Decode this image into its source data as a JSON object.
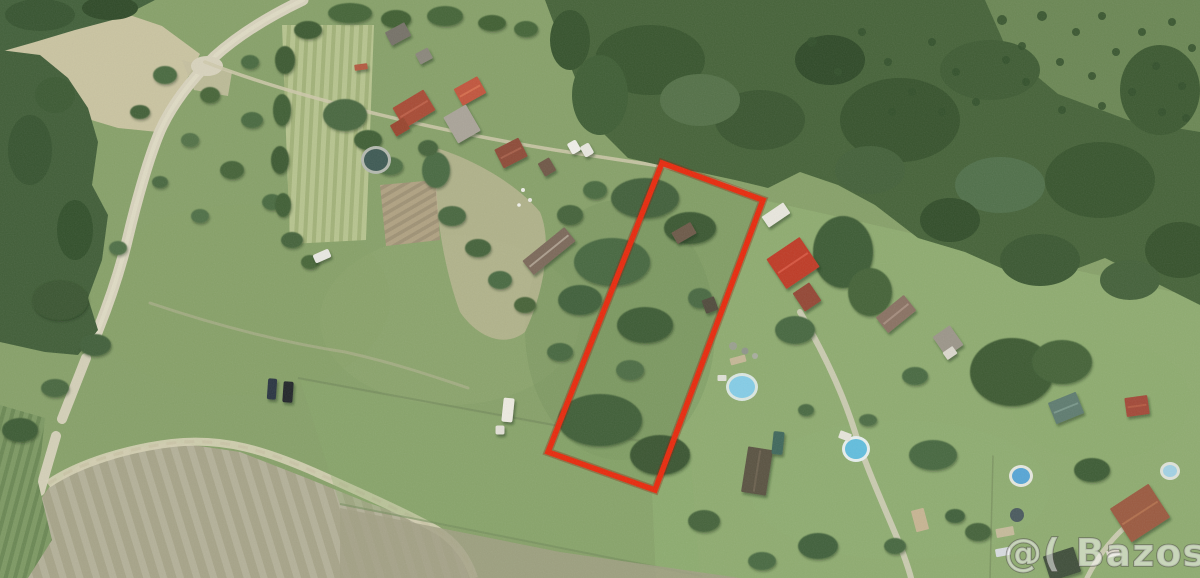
{
  "scene": {
    "label": "aerial-satellite-photo-of-rural-land-parcels",
    "base_color": "#87a169",
    "palette": {
      "grass": "#87a169",
      "lawn_bright": "#8fac70",
      "forest": "#466339",
      "dry_field": "#cac4a1",
      "road": "#d8d3bd",
      "mowed_field": "#a7a489"
    },
    "trees": [
      [
        165,
        75,
        12,
        9,
        "#4a6a40"
      ],
      [
        210,
        95,
        10,
        8,
        "#466539"
      ],
      [
        252,
        120,
        11,
        8,
        "#4a6a40"
      ],
      [
        190,
        140,
        9,
        7,
        "#527247"
      ],
      [
        232,
        170,
        12,
        9,
        "#446339"
      ],
      [
        272,
        202,
        10,
        8,
        "#4a6a40"
      ],
      [
        200,
        216,
        9,
        7,
        "#507046"
      ],
      [
        160,
        182,
        8,
        6,
        "#486740"
      ],
      [
        292,
        240,
        11,
        8,
        "#44633a"
      ],
      [
        250,
        62,
        9,
        7,
        "#4a6a40"
      ],
      [
        310,
        262,
        9,
        7,
        "#476639"
      ],
      [
        140,
        112,
        10,
        7,
        "#426138"
      ],
      [
        350,
        13,
        22,
        10,
        "#456538"
      ],
      [
        396,
        19,
        15,
        9,
        "#3f5e33"
      ],
      [
        445,
        16,
        18,
        10,
        "#456538"
      ],
      [
        492,
        23,
        14,
        8,
        "#3f5e33"
      ],
      [
        526,
        29,
        12,
        8,
        "#456538"
      ],
      [
        308,
        30,
        14,
        9,
        "#3c5a31"
      ],
      [
        285,
        60,
        10,
        14,
        "#3c5a31"
      ],
      [
        282,
        110,
        9,
        16,
        "#3f5e35"
      ],
      [
        280,
        160,
        9,
        14,
        "#3c5a31"
      ],
      [
        283,
        205,
        8,
        12,
        "#405f36"
      ],
      [
        345,
        115,
        22,
        16,
        "#486840"
      ],
      [
        368,
        140,
        14,
        10,
        "#3f5f36"
      ],
      [
        436,
        170,
        14,
        18,
        "#4a6a42"
      ],
      [
        428,
        148,
        10,
        8,
        "#44633a"
      ],
      [
        390,
        166,
        13,
        9,
        "#507045"
      ],
      [
        452,
        216,
        14,
        10,
        "#486840"
      ],
      [
        478,
        248,
        13,
        9,
        "#44633a"
      ],
      [
        500,
        280,
        12,
        9,
        "#4a6a42"
      ],
      [
        525,
        305,
        11,
        8,
        "#466439"
      ],
      [
        570,
        215,
        13,
        10,
        "#44633a"
      ],
      [
        595,
        190,
        12,
        9,
        "#4a6a40"
      ],
      [
        645,
        198,
        34,
        20,
        "#42603a"
      ],
      [
        690,
        228,
        26,
        16,
        "#3b5833"
      ],
      [
        612,
        262,
        38,
        24,
        "#476741"
      ],
      [
        580,
        300,
        22,
        15,
        "#40603a"
      ],
      [
        645,
        325,
        28,
        18,
        "#3d5c35"
      ],
      [
        700,
        298,
        12,
        10,
        "#486942"
      ],
      [
        600,
        420,
        42,
        26,
        "#415f39"
      ],
      [
        660,
        455,
        30,
        20,
        "#3a5732"
      ],
      [
        560,
        352,
        13,
        9,
        "#47673f"
      ],
      [
        630,
        370,
        14,
        10,
        "#4d6d45"
      ],
      [
        843,
        252,
        30,
        36,
        "#3d5c35"
      ],
      [
        870,
        292,
        22,
        24,
        "#446339"
      ],
      [
        795,
        330,
        20,
        14,
        "#47673f"
      ],
      [
        915,
        376,
        13,
        9,
        "#4a6a42"
      ],
      [
        1012,
        372,
        42,
        34,
        "#3c5a33"
      ],
      [
        1062,
        362,
        30,
        22,
        "#446339"
      ],
      [
        933,
        455,
        24,
        15,
        "#47673f"
      ],
      [
        818,
        546,
        20,
        13,
        "#40603a"
      ],
      [
        704,
        521,
        16,
        11,
        "#44633a"
      ],
      [
        762,
        561,
        14,
        9,
        "#4a6a42"
      ],
      [
        895,
        546,
        11,
        8,
        "#47673f"
      ],
      [
        1092,
        470,
        18,
        12,
        "#3d5c35"
      ],
      [
        978,
        532,
        13,
        9,
        "#44633a"
      ],
      [
        955,
        516,
        10,
        7,
        "#40603a"
      ],
      [
        868,
        420,
        9,
        6,
        "#4d6d45"
      ],
      [
        806,
        410,
        8,
        6,
        "#4a6a42"
      ],
      [
        60,
        300,
        28,
        20,
        "#3a5731"
      ],
      [
        95,
        345,
        16,
        11,
        "#42613a"
      ],
      [
        55,
        388,
        14,
        9,
        "#486840"
      ],
      [
        20,
        430,
        18,
        12,
        "#3d5c35"
      ],
      [
        118,
        248,
        9,
        7,
        "#507046"
      ]
    ],
    "forest_blobs": [
      [
        650,
        60,
        55,
        35,
        "#38552e"
      ],
      [
        760,
        120,
        45,
        30,
        "#3a5630"
      ],
      [
        900,
        120,
        60,
        42,
        "#37532d"
      ],
      [
        990,
        70,
        50,
        30,
        "#3f5c34"
      ],
      [
        1100,
        180,
        55,
        38,
        "#38552e"
      ],
      [
        1160,
        90,
        40,
        45,
        "#3c5931"
      ],
      [
        830,
        60,
        35,
        25,
        "#2f4a28"
      ],
      [
        700,
        100,
        40,
        26,
        "#547148"
      ],
      [
        1000,
        185,
        45,
        28,
        "#50704a"
      ],
      [
        600,
        95,
        28,
        40,
        "#3f5e35"
      ],
      [
        1180,
        250,
        35,
        28,
        "#36522c"
      ],
      [
        1040,
        260,
        40,
        26,
        "#3b5832"
      ],
      [
        950,
        220,
        30,
        22,
        "#324e2a"
      ],
      [
        870,
        170,
        35,
        24,
        "#44613a"
      ],
      [
        1130,
        280,
        30,
        20,
        "#44613a"
      ],
      [
        570,
        40,
        20,
        30,
        "#36532d"
      ],
      [
        40,
        15,
        35,
        16,
        "#375430"
      ],
      [
        110,
        8,
        28,
        12,
        "#2f4a28"
      ],
      [
        30,
        150,
        22,
        35,
        "#375430"
      ],
      [
        75,
        230,
        18,
        30,
        "#32502b"
      ],
      [
        55,
        95,
        20,
        18,
        "#3c5a33"
      ]
    ],
    "orchard_dots": [
      [
        1002,
        20,
        5
      ],
      [
        1022,
        46,
        4
      ],
      [
        1042,
        16,
        5
      ],
      [
        1060,
        62,
        4
      ],
      [
        1076,
        32,
        4
      ],
      [
        1092,
        76,
        4
      ],
      [
        1102,
        16,
        4
      ],
      [
        1116,
        52,
        4
      ],
      [
        1132,
        92,
        4
      ],
      [
        1142,
        32,
        4
      ],
      [
        1156,
        66,
        4
      ],
      [
        1172,
        22,
        4
      ],
      [
        1182,
        86,
        4
      ],
      [
        1192,
        48,
        4
      ],
      [
        1062,
        110,
        4
      ],
      [
        1102,
        106,
        4
      ],
      [
        1162,
        112,
        4
      ],
      [
        1186,
        118,
        4
      ],
      [
        1026,
        82,
        4
      ],
      [
        1006,
        60,
        4
      ],
      [
        812,
        42,
        5
      ],
      [
        838,
        72,
        4
      ],
      [
        862,
        32,
        4
      ],
      [
        888,
        62,
        4
      ],
      [
        912,
        92,
        4
      ],
      [
        932,
        42,
        4
      ],
      [
        956,
        72,
        4
      ],
      [
        976,
        102,
        4
      ],
      [
        942,
        112,
        4
      ],
      [
        892,
        112,
        4
      ]
    ],
    "houses": [
      [
        398,
        34,
        22,
        15,
        -28,
        "#767268",
        ""
      ],
      [
        414,
        109,
        36,
        24,
        -31,
        "#a84c35",
        "#c06048"
      ],
      [
        400,
        127,
        16,
        13,
        -31,
        "#99452f",
        ""
      ],
      [
        470,
        91,
        27,
        19,
        -29,
        "#c2543c",
        "#d8704f"
      ],
      [
        462,
        124,
        26,
        30,
        -30,
        "#aaa499",
        ""
      ],
      [
        511,
        153,
        27,
        21,
        -27,
        "#8e4c39",
        "#a9614b"
      ],
      [
        547,
        167,
        13,
        15,
        -30,
        "#6f5847",
        ""
      ],
      [
        549,
        251,
        54,
        18,
        -39,
        "#7b695a",
        "#b2a494"
      ],
      [
        684,
        233,
        22,
        13,
        -30,
        "#6d5a49",
        ""
      ],
      [
        710,
        305,
        13,
        14,
        -20,
        "#514c3c",
        ""
      ],
      [
        776,
        215,
        26,
        13,
        -34,
        "#e9e7de",
        ""
      ],
      [
        793,
        263,
        40,
        36,
        -34,
        "#bf3a28",
        "#da5a42"
      ],
      [
        807,
        297,
        20,
        22,
        -34,
        "#944736",
        ""
      ],
      [
        896,
        314,
        36,
        20,
        -39,
        "#8a7263",
        "#a89181"
      ],
      [
        948,
        341,
        21,
        24,
        -35,
        "#9c968a",
        ""
      ],
      [
        950,
        353,
        12,
        9,
        -35,
        "#dbd8cd",
        ""
      ],
      [
        1066,
        408,
        30,
        23,
        -22,
        "#5e7b70",
        "#7d9b8d"
      ],
      [
        1137,
        406,
        23,
        19,
        -8,
        "#a34a37",
        "#b85c44"
      ],
      [
        757,
        471,
        25,
        46,
        9,
        "#5a5242",
        "#6e6452"
      ],
      [
        1140,
        513,
        46,
        40,
        -33,
        "#9b5a41",
        "#b5724f"
      ],
      [
        1062,
        564,
        32,
        26,
        -18,
        "#41503a",
        ""
      ],
      [
        424,
        56,
        14,
        12,
        -28,
        "#8b877c",
        ""
      ],
      [
        361,
        67,
        13,
        6,
        -8,
        "#b35a40",
        ""
      ]
    ],
    "pools": [
      [
        376,
        160,
        12,
        11,
        "#3e5a54",
        "#b5bab0"
      ],
      [
        742,
        387,
        13,
        11,
        "#85cde7",
        "#dce8e2"
      ],
      [
        856,
        449,
        11,
        10,
        "#62bede",
        "#e8f0ef"
      ],
      [
        1021,
        476,
        9,
        8,
        "#57a6d6",
        "#e6e8df"
      ],
      [
        1170,
        471,
        7,
        6,
        "#a3d2e4",
        "#dfe3da"
      ]
    ],
    "vehicles": [
      [
        272,
        389,
        9,
        21,
        4,
        "#2c3642"
      ],
      [
        288,
        392,
        10,
        21,
        4,
        "#23272b"
      ],
      [
        322,
        256,
        17,
        9,
        -24,
        "#e9e9e3"
      ],
      [
        508,
        410,
        11,
        24,
        6,
        "#edebe1"
      ],
      [
        500,
        430,
        9,
        9,
        0,
        "#e2e0d6"
      ],
      [
        574,
        147,
        10,
        12,
        -30,
        "#f0efe9"
      ],
      [
        587,
        150,
        10,
        12,
        -30,
        "#e8e7df"
      ],
      [
        778,
        443,
        11,
        23,
        6,
        "#40685c"
      ]
    ],
    "object_rects": [
      [
        920,
        520,
        13,
        22,
        -15,
        "#c8b593"
      ],
      [
        1005,
        532,
        18,
        9,
        -10,
        "#c6bb9b"
      ],
      [
        1113,
        553,
        13,
        7,
        -15,
        "#dcd8cb"
      ],
      [
        738,
        360,
        16,
        7,
        -15,
        "#c5b796"
      ],
      [
        1003,
        552,
        15,
        8,
        -10,
        "#d8dce0"
      ],
      [
        845,
        436,
        12,
        8,
        20,
        "#e6e4da"
      ],
      [
        722,
        378,
        9,
        6,
        0,
        "#dfe0d6"
      ]
    ],
    "object_dots": [
      [
        733,
        346,
        4,
        "#9aa08f"
      ],
      [
        745,
        351,
        3.5,
        "#8f958a"
      ],
      [
        755,
        356,
        3,
        "#a8ad9e"
      ],
      [
        1017,
        515,
        7,
        "#4a5a5e"
      ],
      [
        523,
        190,
        2,
        "#eeeee8"
      ],
      [
        530,
        200,
        2,
        "#e8e8e0"
      ],
      [
        519,
        205,
        1.8,
        "#f0f0ea"
      ]
    ]
  },
  "plot": {
    "label": "highlighted-parcel-outline",
    "points": "662,163 763,200 655,490 548,452",
    "stroke_color": "#e8290c",
    "shadow_color": "#8c1e06",
    "stroke_width": "5.5"
  },
  "watermark": {
    "text": "@( Bazos.cz",
    "fill": "rgba(255,255,255,0.5)",
    "outline": "#55564f"
  }
}
